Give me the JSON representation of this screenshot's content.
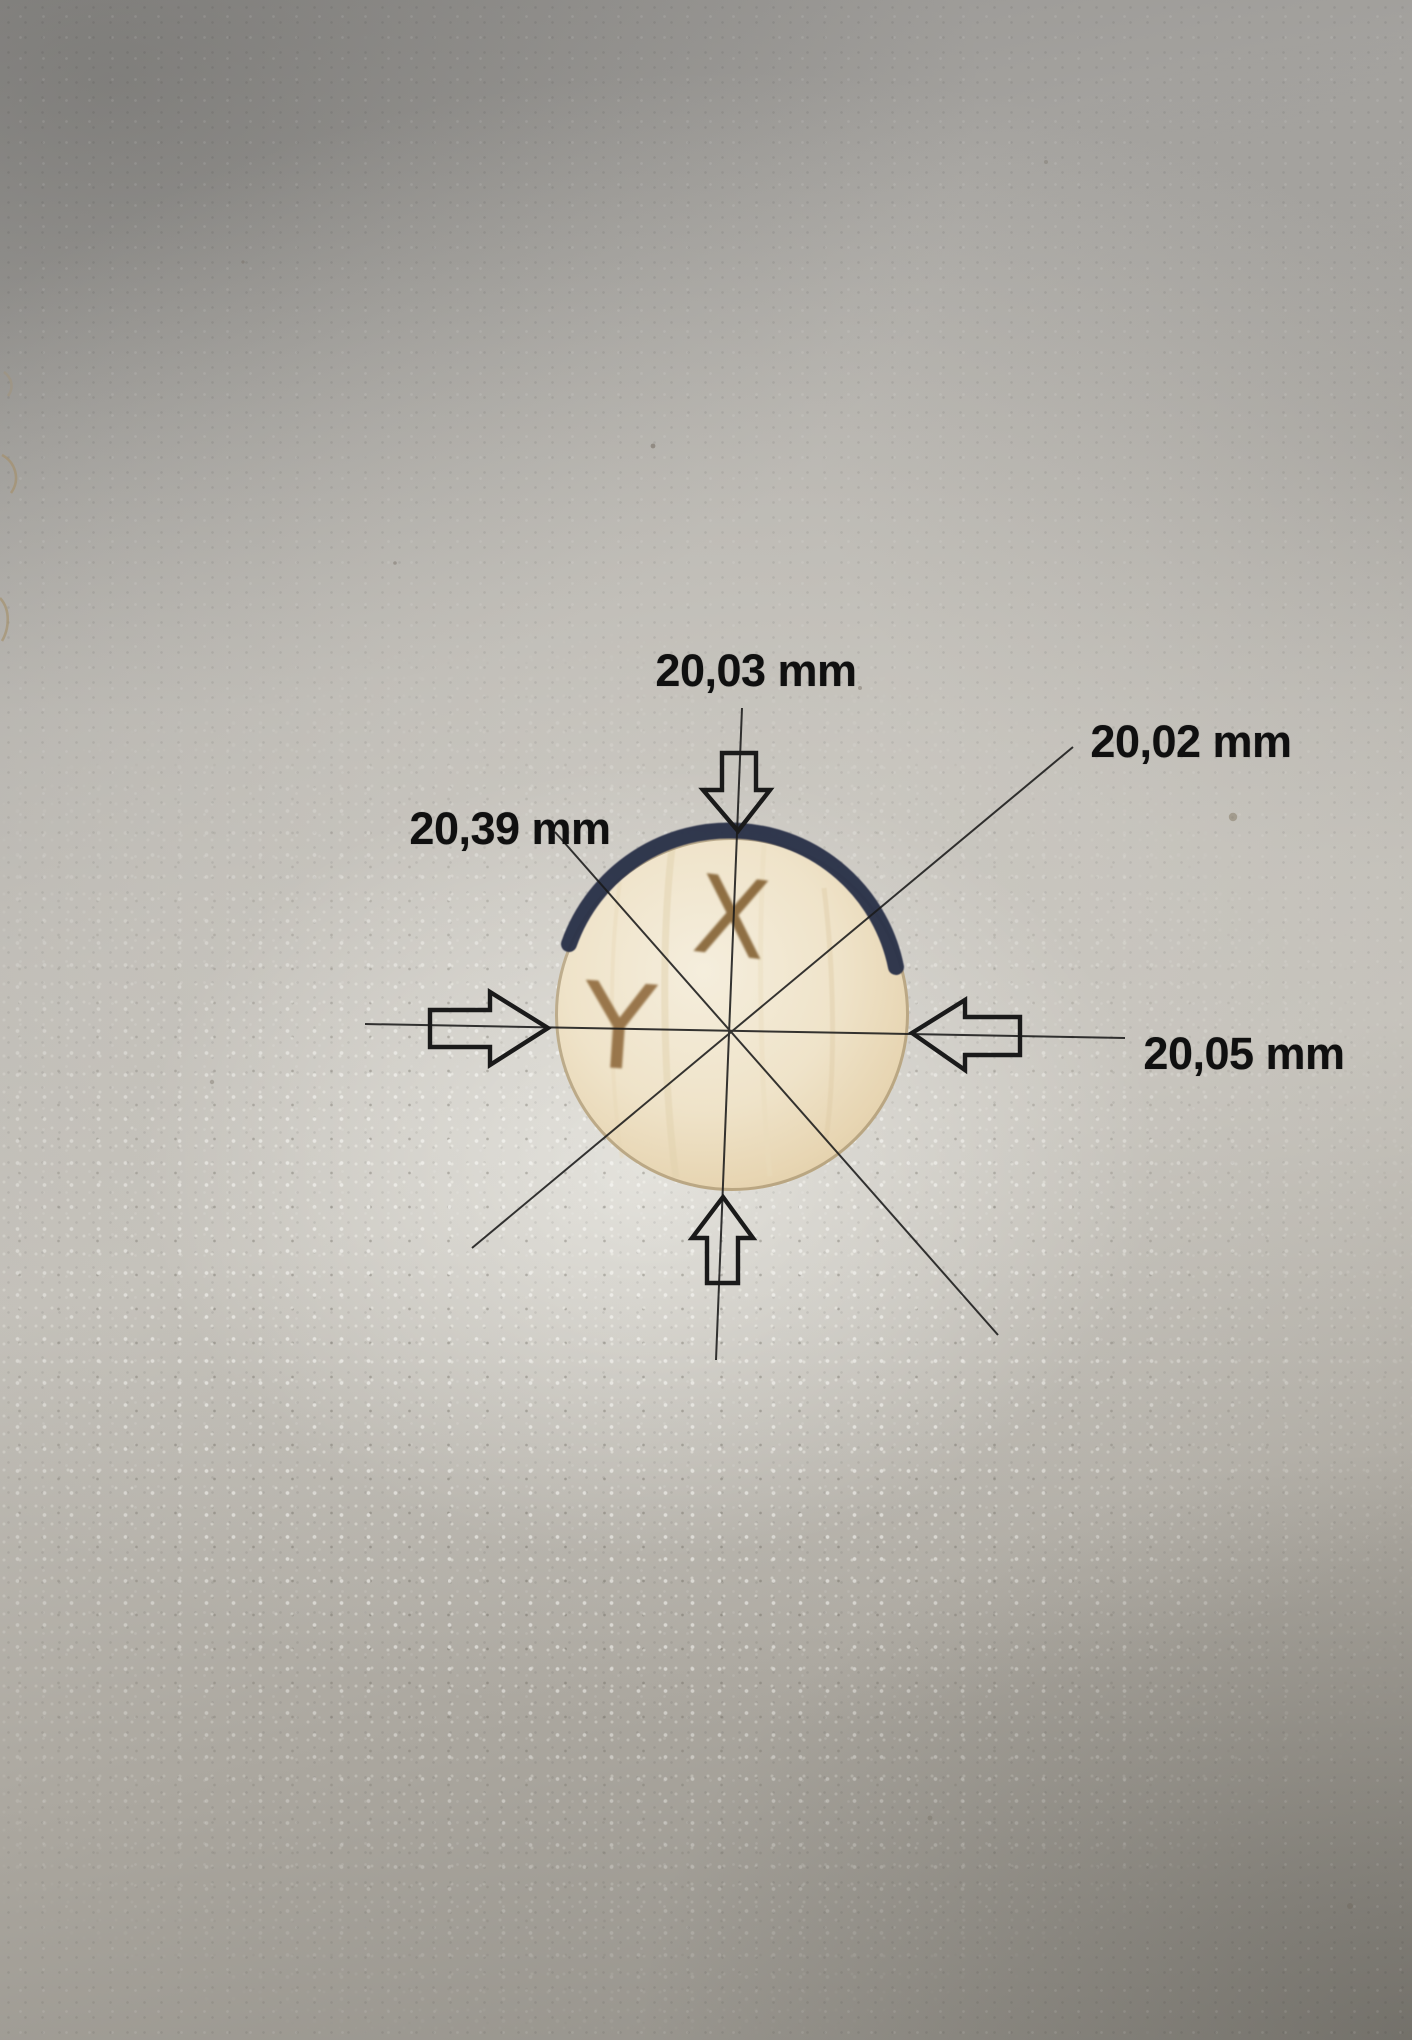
{
  "photo": {
    "measurements": {
      "top": {
        "label": "20,03 mm",
        "direction": "vertical-top"
      },
      "diagonal_ne": {
        "label": "20,02 mm",
        "direction": "diagonal-upper-right"
      },
      "diagonal_nw": {
        "label": "20,39 mm",
        "direction": "diagonal-upper-left"
      },
      "horizontal": {
        "label": "20,05 mm",
        "direction": "horizontal"
      }
    },
    "disc": {
      "letter_x": "X",
      "letter_y": "Y"
    }
  },
  "colors": {
    "annotation-ink": "#1a1a1a",
    "label-ink": "#101010",
    "navy-rim": "#2b3049",
    "wood-face": "#efe5cf",
    "wood-edge": "#8d7a57",
    "burn-mark": "#7e5a2c"
  }
}
